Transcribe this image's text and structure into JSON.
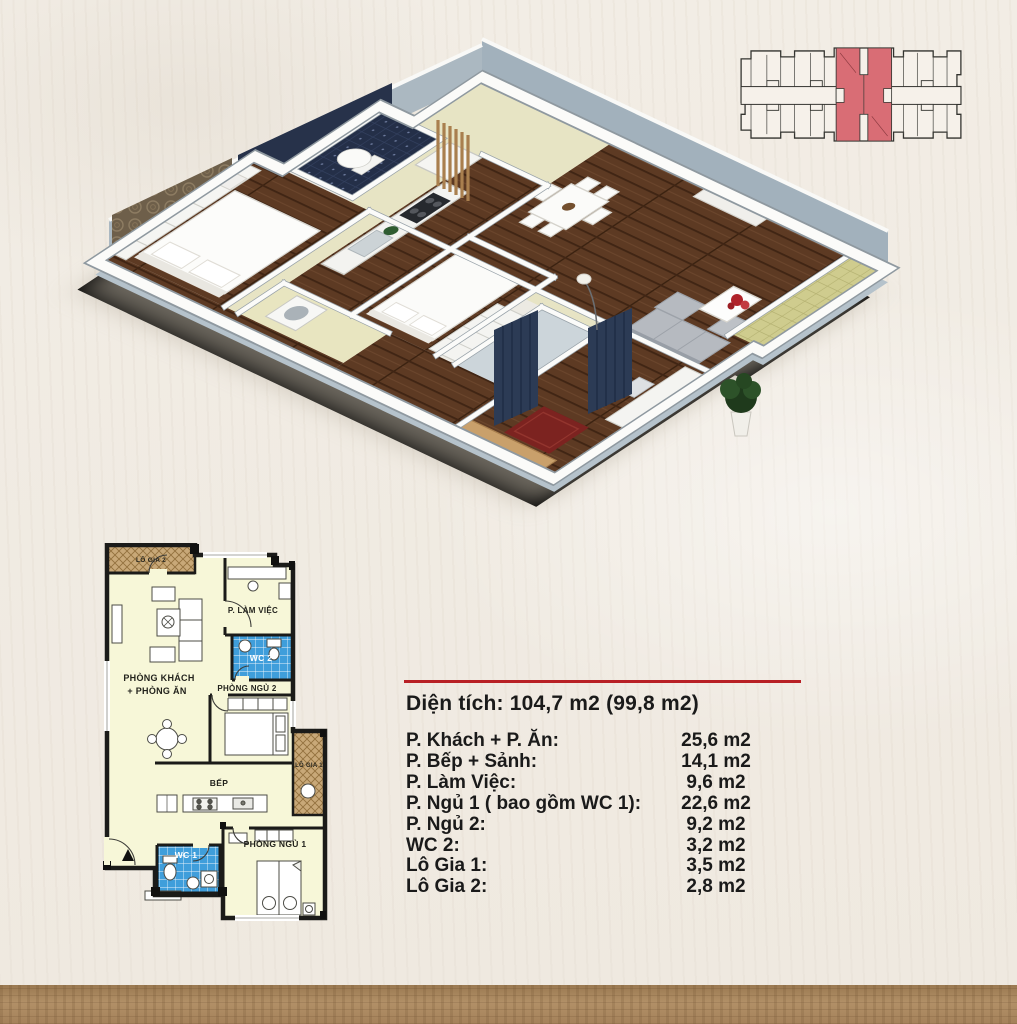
{
  "colors": {
    "bg": "#f2ede5",
    "red": "#b82025",
    "key": "#d96d75",
    "wall": "#1b1b19",
    "yellow": "#f7f7d8",
    "wcblue": "#3f9edb",
    "tan": "#c8a878",
    "wood": "#5d3a23",
    "band": "#a2b1bc",
    "ink": "#1a1a1a",
    "strip": "#ad8a60"
  },
  "plan2d": {
    "labels": {
      "lo_gia_2": "LÔ GIA 2",
      "lam_viec": "P. LÀM VIỆC",
      "wc2": "WC 2",
      "khach_1": "PHÒNG KHÁCH",
      "khach_2": "+ PHÒNG ĂN",
      "ngu2": "PHÒNG NGỦ 2",
      "lo_gia_1": "LÔ GIA 1",
      "bep": "BẾP",
      "wc1": "WC 1",
      "ngu1": "PHÒNG NGỦ 1"
    }
  },
  "area_table": {
    "title": "Diện tích: 104,7 m2 (99,8 m2)",
    "rows": [
      {
        "label": "P. Khách + P. Ăn:",
        "value": "25,6 m2"
      },
      {
        "label": "P. Bếp + Sảnh:",
        "value": "14,1 m2"
      },
      {
        "label": "P. Làm Việc:",
        "value": "9,6 m2"
      },
      {
        "label": "P. Ngủ 1 ( bao gồm WC 1):",
        "value": "22,6 m2"
      },
      {
        "label": "P. Ngủ 2:",
        "value": "9,2 m2"
      },
      {
        "label": "WC 2:",
        "value": "3,2 m2"
      },
      {
        "label": "Lô Gia 1:",
        "value": "3,5 m2"
      },
      {
        "label": "Lô Gia 2:",
        "value": "2,8 m2"
      }
    ]
  }
}
